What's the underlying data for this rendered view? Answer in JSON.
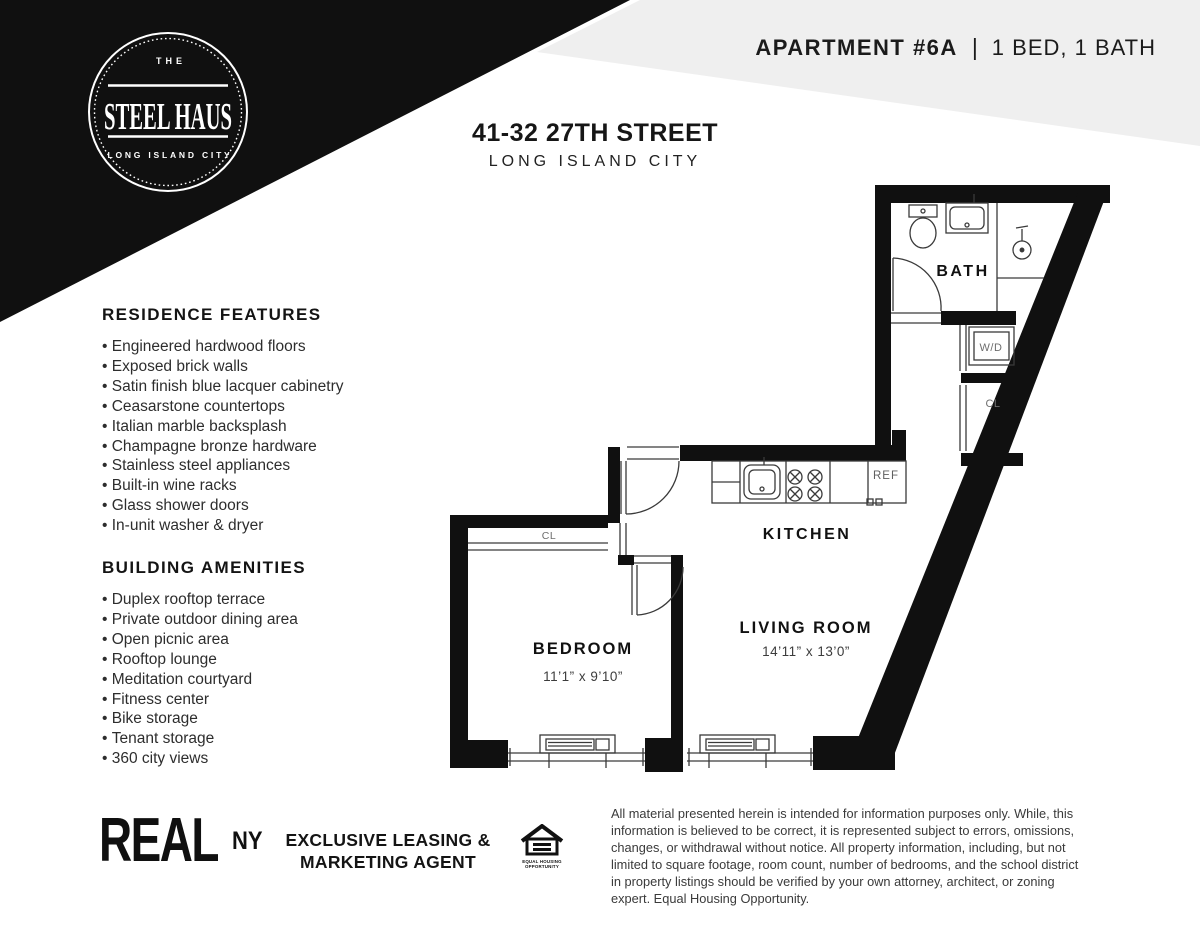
{
  "page": {
    "accent_black": "#101010",
    "band_gray": "#efefef"
  },
  "logo": {
    "the": "THE",
    "name": "STEEL HAUS",
    "location": "LONG ISLAND CITY"
  },
  "header": {
    "apartment": "APARTMENT #6A",
    "separator": "|",
    "unit_info": "1 BED, 1 BATH"
  },
  "address": {
    "line1": "41-32 27TH STREET",
    "line2": "LONG ISLAND CITY"
  },
  "residence_features": {
    "title": "RESIDENCE FEATURES",
    "items": [
      "Engineered hardwood floors",
      "Exposed brick walls",
      "Satin finish blue lacquer cabinetry",
      "Ceasarstone countertops",
      "Italian marble backsplash",
      "Champagne bronze hardware",
      "Stainless steel appliances",
      "Built-in wine racks",
      "Glass shower doors",
      "In-unit washer & dryer"
    ]
  },
  "building_amenities": {
    "title": "BUILDING AMENITIES",
    "items": [
      "Duplex rooftop terrace",
      "Private outdoor dining area",
      "Open picnic area",
      "Rooftop lounge",
      "Meditation courtyard",
      "Fitness center",
      "Bike storage",
      "Tenant storage",
      "360 city views"
    ]
  },
  "floorplan": {
    "rooms": {
      "bath": {
        "label": "BATH"
      },
      "washer_dryer": {
        "label": "W/D"
      },
      "closet_hall": {
        "label": "CL"
      },
      "refrigerator": {
        "label": "REF"
      },
      "kitchen": {
        "label": "KITCHEN"
      },
      "closet_bedroom": {
        "label": "CL"
      },
      "bedroom": {
        "label": "BEDROOM",
        "dims": "11’1” x 9’10”"
      },
      "living_room": {
        "label": "LIVING ROOM",
        "dims": "14’11” x 13’0”"
      }
    }
  },
  "footer": {
    "brand": {
      "real": "REAL",
      "ny": "NY"
    },
    "agent_line1": "EXCLUSIVE LEASING &",
    "agent_line2": "MARKETING AGENT",
    "equal_housing": {
      "line1": "EQUAL HOUSING",
      "line2": "OPPORTUNITY"
    },
    "disclaimer": "All material presented herein is intended for information purposes only. While, this information is believed to be correct, it is represented subject to errors, omissions, changes, or withdrawal without notice. All property information, including, but not limited to square footage, room count, number of bedrooms, and the school district in property listings should be verified by your own attorney, architect, or zoning expert. Equal Housing Opportunity."
  }
}
